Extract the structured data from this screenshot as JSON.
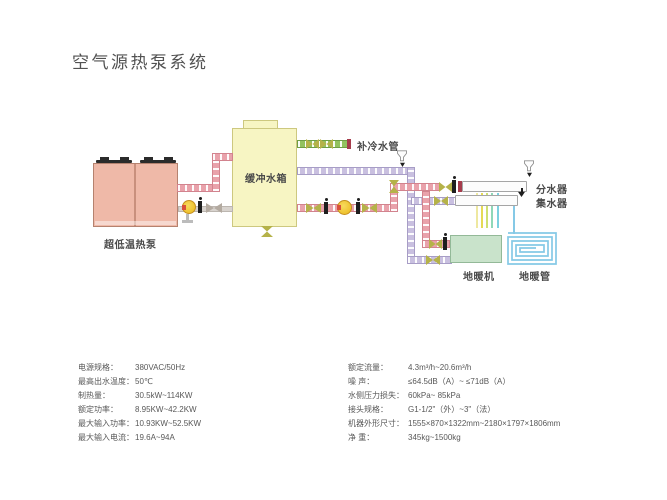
{
  "header": {
    "title": "空气源热泵系统"
  },
  "diagram": {
    "labels": {
      "heat_pump": "超低温热泵",
      "buffer_tank": "缓冲水箱",
      "cold_water_pipe": "补冷水管",
      "distributor": "分水器",
      "collector": "集水器",
      "floor_heating_unit": "地暖机",
      "floor_heating_pipe": "地暖管"
    },
    "palette": {
      "hot_supply_pipe": "#e9a2ab",
      "return_pipe": "#c9c0e0",
      "cold_water_pipe": "#93c25f",
      "heat_pump_fill": "#efb9a8",
      "buffer_tank_fill": "#f7f5c3",
      "floor_unit_fill": "#c9e3cb",
      "floor_coil_blue": "#85c9e6",
      "pump_yellow": "#eec22e"
    }
  },
  "specs": {
    "left": [
      {
        "label": "电源规格：",
        "value": "380VAC/50Hz"
      },
      {
        "label": "最高出水温度：",
        "value": "50℃"
      },
      {
        "label": "制热量：",
        "value": "30.5kW~114KW"
      },
      {
        "label": "额定功率：",
        "value": "8.95KW~42.2KW"
      },
      {
        "label": "最大输入功率：",
        "value": "10.93KW~52.5KW"
      },
      {
        "label": "最大输入电流：",
        "value": "19.6A~94A"
      }
    ],
    "right": [
      {
        "label": "额定流量：",
        "value": "4.3m³/h~20.6m³/h"
      },
      {
        "label": "噪 声：",
        "value": "≤64.5dB（A）~ ≤71dB（A）"
      },
      {
        "label": "水侧压力损失：",
        "value": "60kPa~ 85kPa"
      },
      {
        "label": "接头规格：",
        "value": "G1-1/2\"（外）~3\"（法）"
      },
      {
        "label": "机器外形尺寸：",
        "value": "1555×870×1322mm~2180×1797×1806mm"
      },
      {
        "label": "净 重：",
        "value": "345kg~1500kg"
      }
    ]
  }
}
